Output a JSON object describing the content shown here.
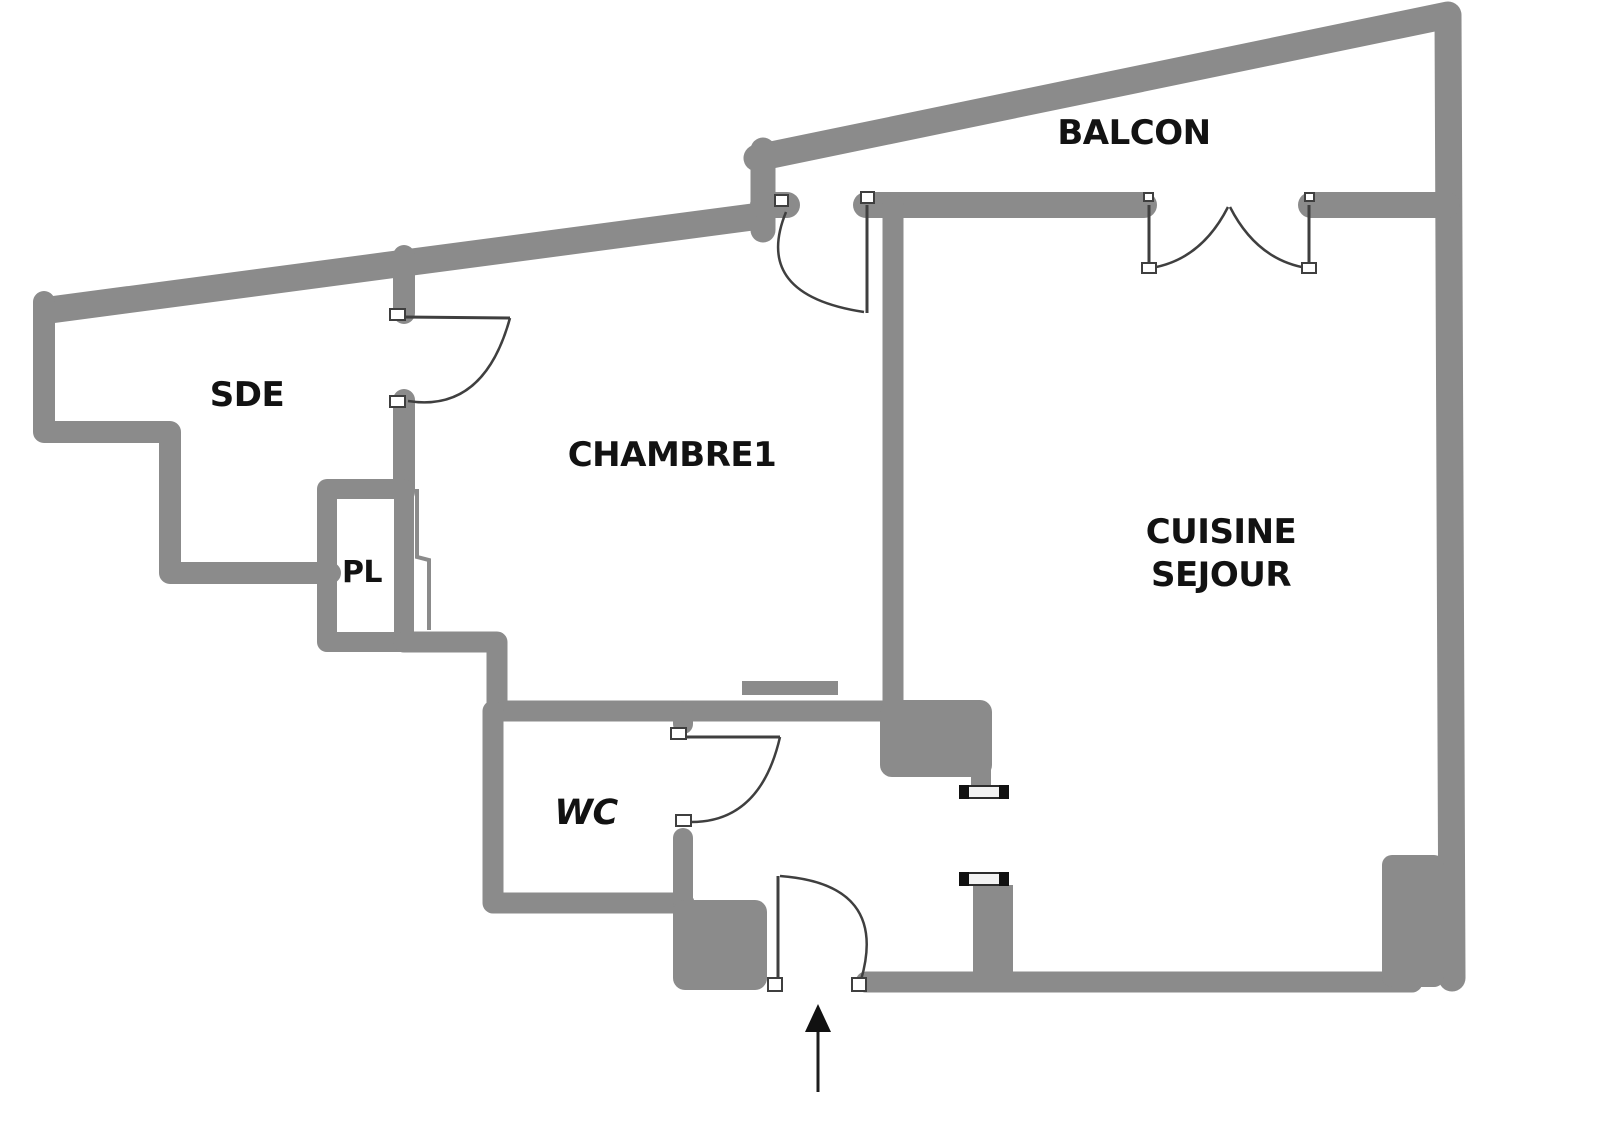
{
  "title": "Floor plan",
  "colors": {
    "wall": "#8b8b8b",
    "stroke": "#3f3f3f",
    "text": "#121212"
  },
  "rooms": {
    "balcon": {
      "label": "BALCON"
    },
    "sde": {
      "label": "SDE"
    },
    "chambre1": {
      "label": "CHAMBRE1"
    },
    "pl": {
      "label": "PL"
    },
    "wc": {
      "label": "WC"
    },
    "cuisine": {
      "line1": "CUISINE",
      "line2": "SEJOUR"
    }
  },
  "icons": {
    "entry_arrow": "up-arrow-entrance"
  }
}
